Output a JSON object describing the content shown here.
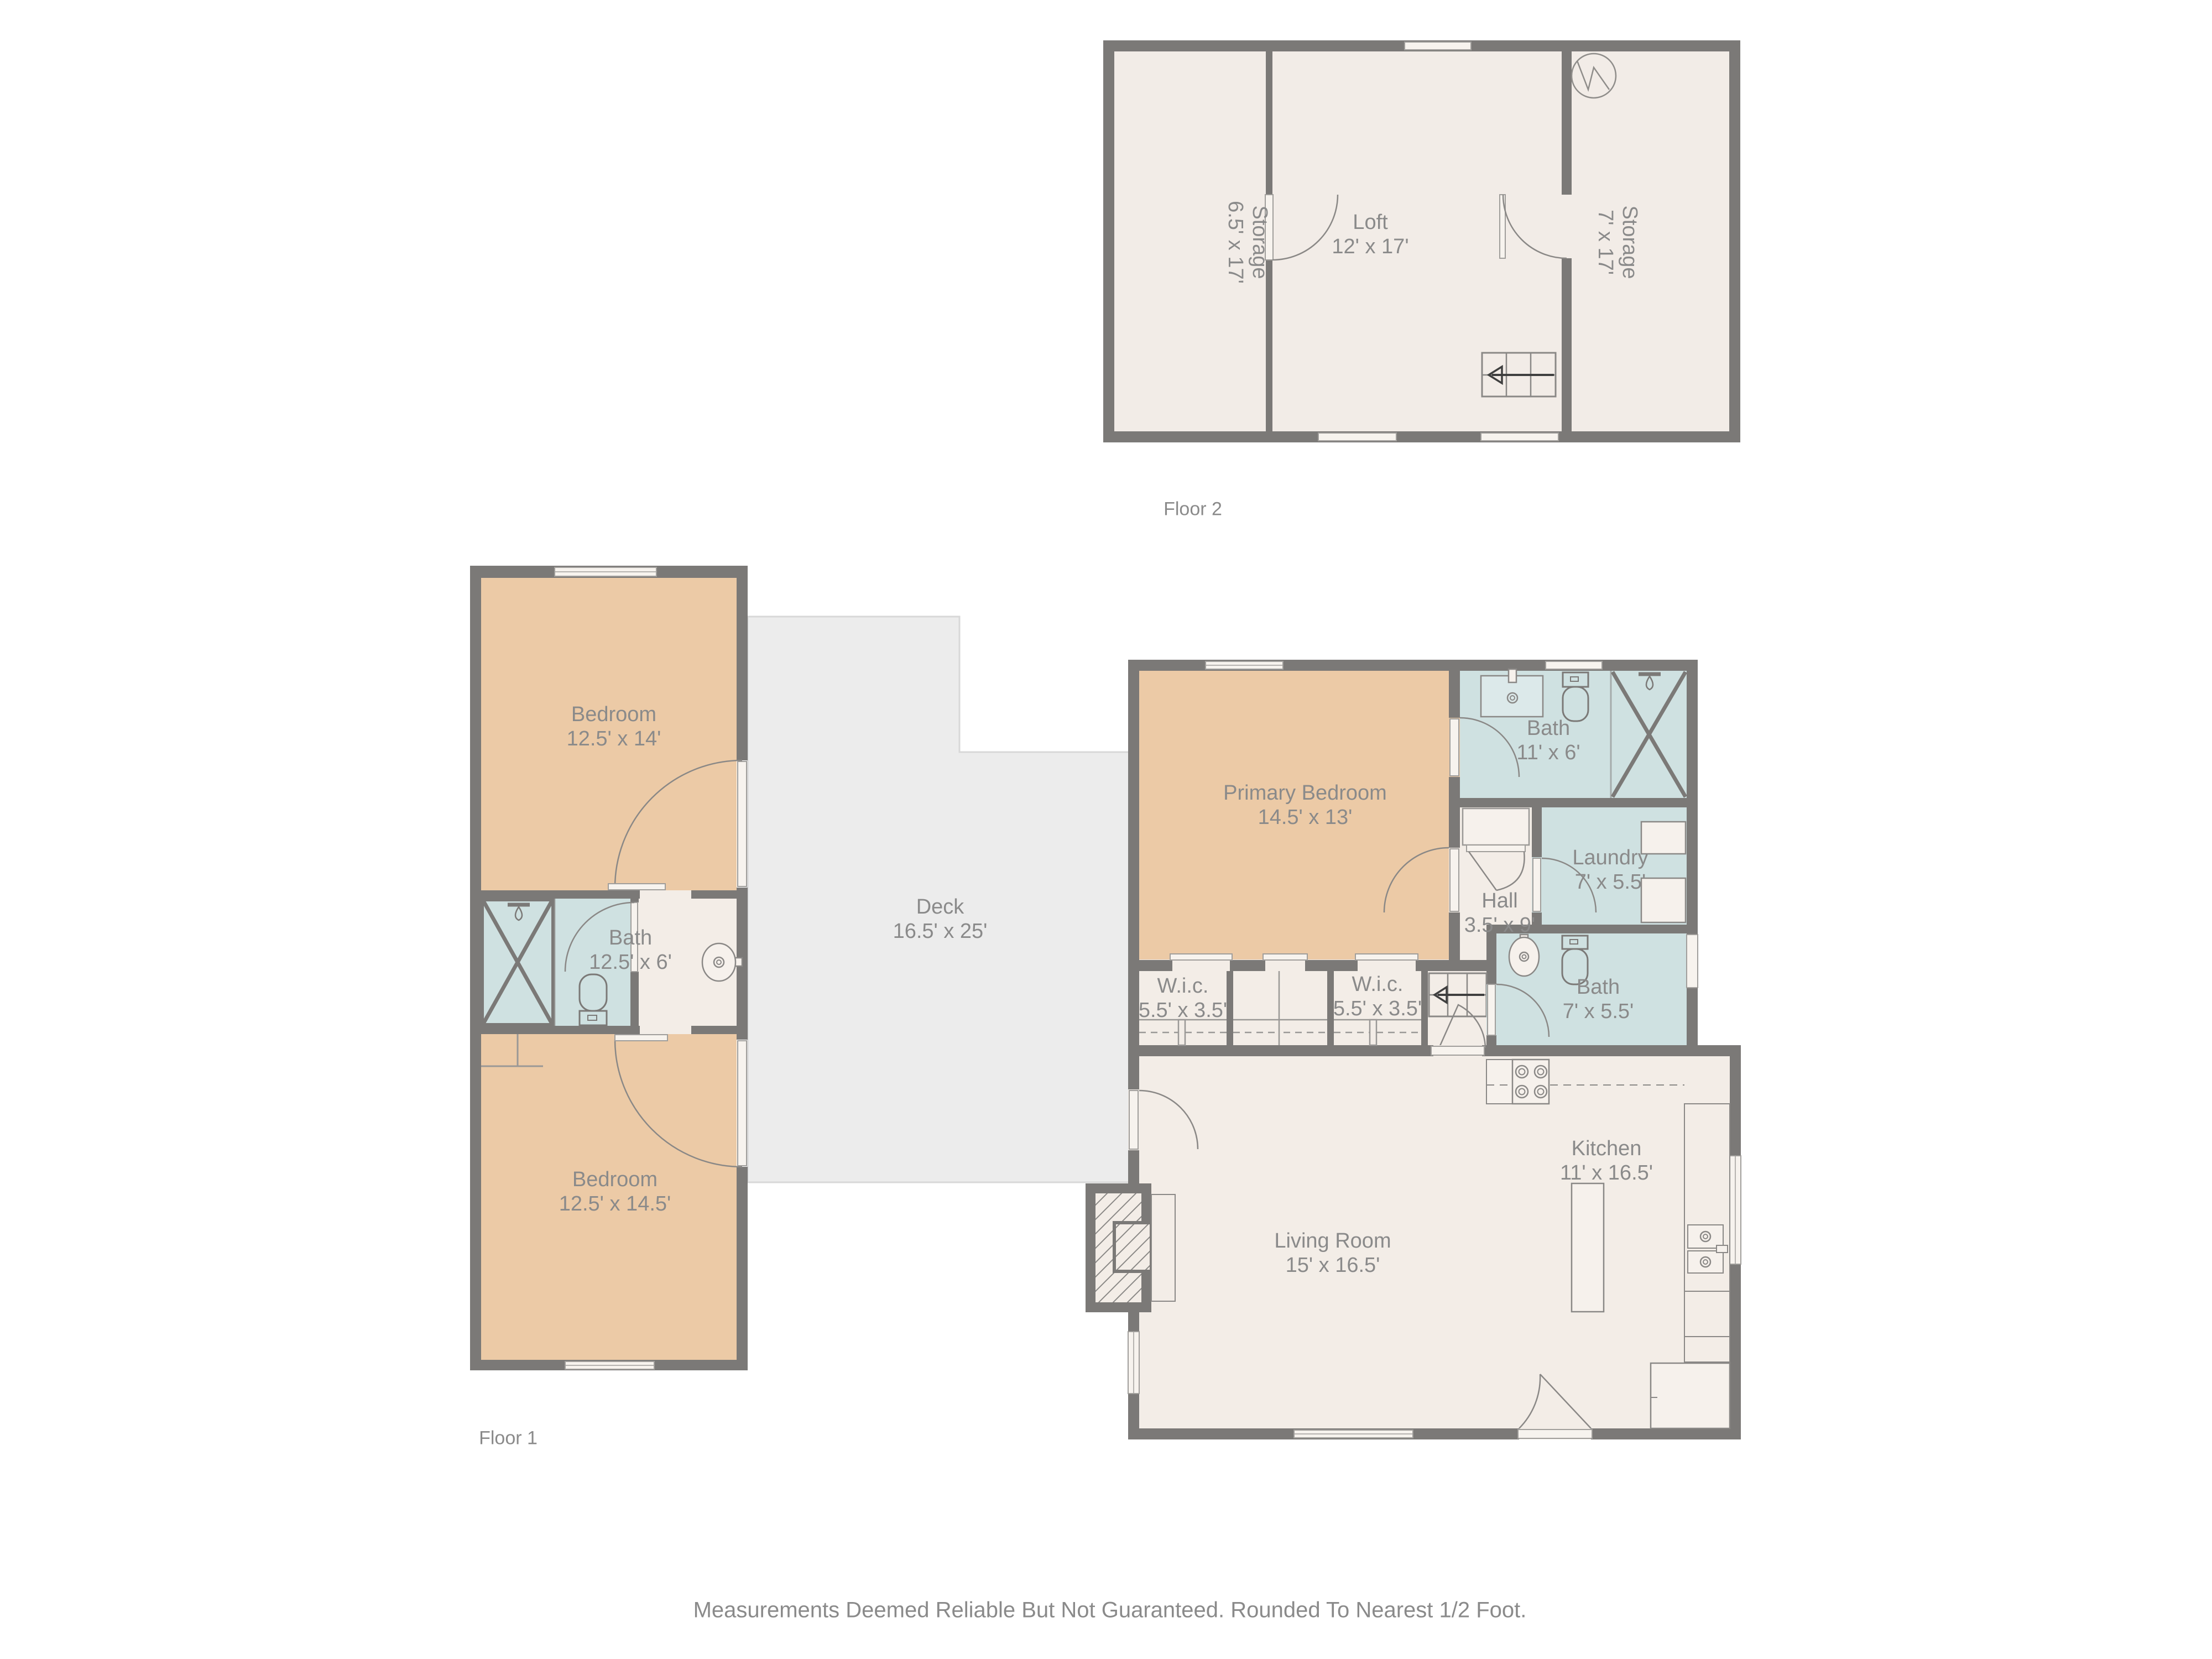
{
  "page": {
    "footer": "Measurements Deemed Reliable But Not Guaranteed. Rounded To Nearest 1/2 Foot."
  },
  "colors": {
    "wall": "#7b7977",
    "floor": "#f3ede7",
    "bedroom": "#eccaa6",
    "bath": "#cfe1e1",
    "deck": "#ececec",
    "label_text": "#8a8a8a",
    "fixture_fill": "#f6f1ec"
  },
  "floor2": {
    "title": "Floor 2",
    "rooms": {
      "storage_left": {
        "name": "Storage",
        "dims": "6.5' x 17'"
      },
      "loft": {
        "name": "Loft",
        "dims": "12' x 17'"
      },
      "storage_right": {
        "name": "Storage",
        "dims": "7' x 17'"
      }
    }
  },
  "floor1": {
    "title": "Floor 1",
    "rooms": {
      "bedroom_top": {
        "name": "Bedroom",
        "dims": "12.5' x 14'"
      },
      "bath_left": {
        "name": "Bath",
        "dims": "12.5' x 6'"
      },
      "bedroom_bottom": {
        "name": "Bedroom",
        "dims": "12.5' x 14.5'"
      },
      "deck": {
        "name": "Deck",
        "dims": "16.5' x 25'"
      },
      "primary_bedroom": {
        "name": "Primary Bedroom",
        "dims": "14.5' x 13'"
      },
      "bath_top": {
        "name": "Bath",
        "dims": "11' x 6'"
      },
      "laundry": {
        "name": "Laundry",
        "dims": "7' x 5.5'"
      },
      "hall": {
        "name": "Hall",
        "dims": "3.5' x 9'"
      },
      "wic_left": {
        "name": "W.i.c.",
        "dims": "5.5' x 3.5'"
      },
      "wic_right": {
        "name": "W.i.c.",
        "dims": "5.5' x 3.5'"
      },
      "bath_bottom": {
        "name": "Bath",
        "dims": "7' x 5.5'"
      },
      "kitchen": {
        "name": "Kitchen",
        "dims": "11' x 16.5'"
      },
      "living_room": {
        "name": "Living Room",
        "dims": "15' x 16.5'"
      }
    }
  }
}
